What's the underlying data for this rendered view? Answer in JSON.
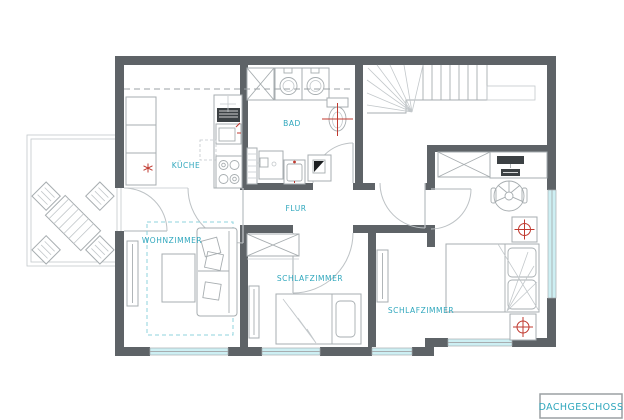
{
  "title": {
    "text": "DACHGESCHOSS"
  },
  "rooms": {
    "kueche": "KÜCHE",
    "bad": "BAD",
    "flur": "FLUR",
    "wohnzimmer": "WOHNZIMMER",
    "schlafzimmer_mitte": "SCHLAFZIMMER",
    "schlafzimmer_rechts": "SCHLAFZIMMER"
  },
  "colors": {
    "wall": "#5e6367",
    "furniture": "#a7adb0",
    "furniture_light": "#c3c8cb",
    "furniture_dark": "#3c4144",
    "label": "#2fa7bd",
    "window": "#cdeff3",
    "accent": "#c0392f",
    "rug": "#8fd3de",
    "door": "#bdc2c5"
  }
}
